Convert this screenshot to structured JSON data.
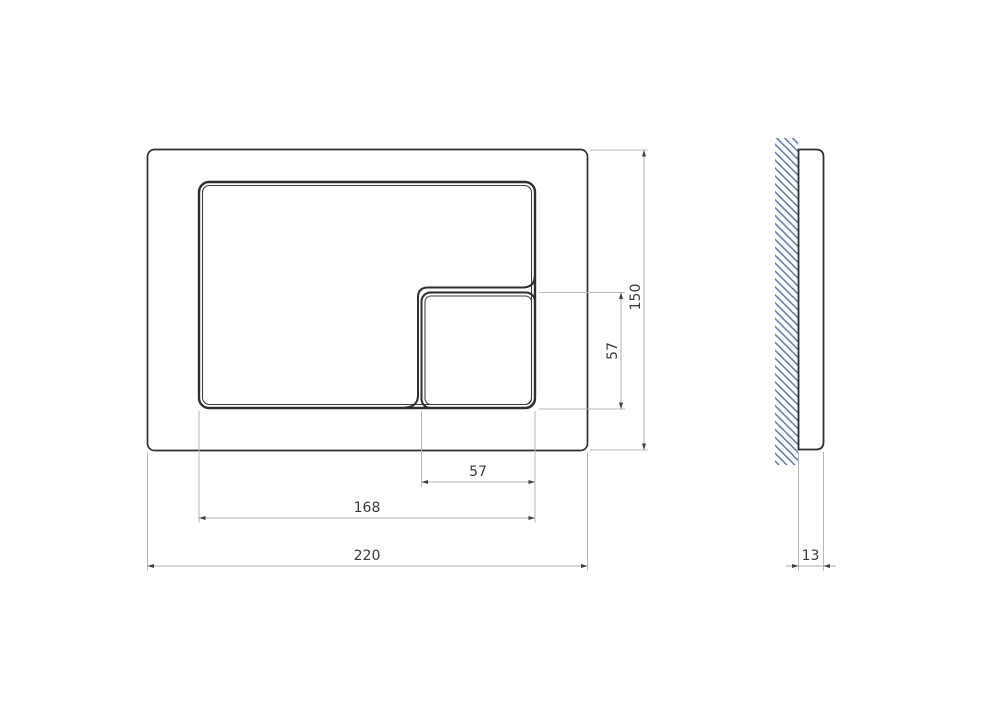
{
  "drawing": {
    "type": "technical-dimension-drawing",
    "views": {
      "front": "flush-plate front view",
      "side": "flush-plate side profile against wall"
    },
    "dimensions": {
      "overall_width": "220",
      "overall_height": "150",
      "button_group_width": "168",
      "small_button_width": "57",
      "small_button_height": "57",
      "plate_thickness": "13"
    },
    "colors": {
      "background": "#ffffff",
      "object_line": "#2e2e2e",
      "dimension_line": "#aeaeae",
      "dimension_text": "#3a3a3a",
      "arrowhead": "#3e3e3e",
      "wall_hatch_blue": "#5b77b0"
    }
  }
}
